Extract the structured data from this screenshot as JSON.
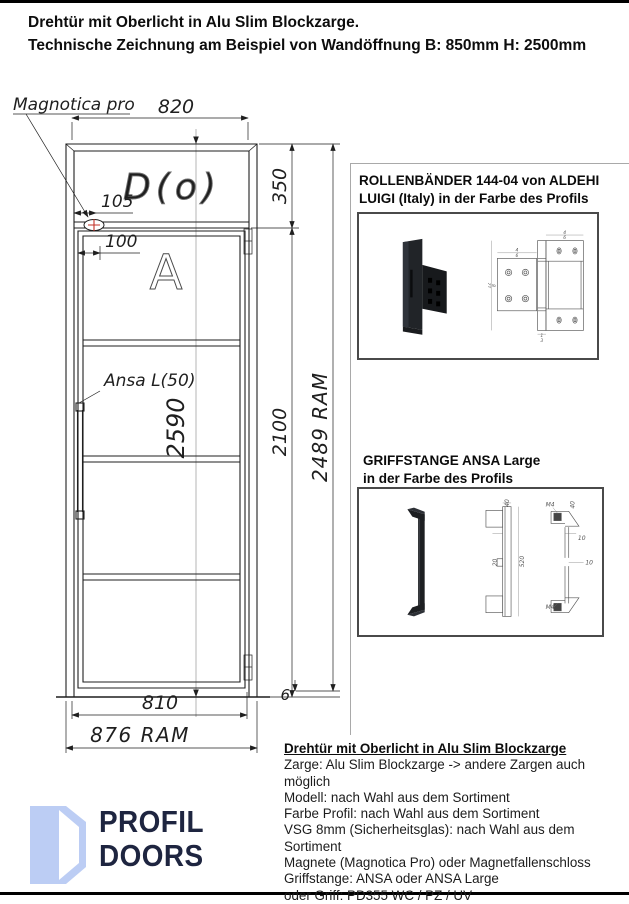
{
  "header": {
    "line1": "Drehtür mit Oberlicht in Alu Slim Blockzarge.",
    "line2": "Technische Zeichnung am Beispiel von Wandöffnung B: 850mm H: 2500mm"
  },
  "drawing": {
    "label_magnet": "Magnotica pro",
    "label_handle": "Ansa L(50)",
    "model_letter": "A",
    "watermark": "D(o)",
    "dim_top_width": "820",
    "dim_transom_height": "350",
    "dim_magnet_offset": "105",
    "dim_top_offset": "100",
    "dim_total_height": "2590",
    "dim_leaf_height": "2100",
    "dim_frame_height": "2489 RAM",
    "dim_leaf_width": "810",
    "dim_frame_width": "876 RAM",
    "dim_floor_gap": "6"
  },
  "hinge_panel": {
    "title_line1": "ROLLENBÄNDER 144-04 von ALDEHI",
    "title_line2": "LUIGI (Italy) in der Farbe des Profils",
    "dims": {
      "a": "4",
      "b": "6",
      "c": "12",
      "d": "3",
      "e": "1",
      "f": "8"
    }
  },
  "handle_panel": {
    "title_line1": "GRIFFSTANGE ANSA Large",
    "title_line2": "in der Farbe des Profils",
    "dims": {
      "d40": "40",
      "d20": "20",
      "d520": "520",
      "d10": "10",
      "m4": "M4"
    }
  },
  "specs": {
    "title": "Drehtür mit Oberlicht in Alu Slim Blockzarge",
    "lines": [
      "Zarge: Alu Slim Blockzarge -> andere Zargen auch möglich",
      "Modell: nach Wahl aus dem Sortiment",
      "Farbe Profil: nach Wahl aus dem Sortiment",
      "VSG 8mm (Sicherheitsglas): nach Wahl aus dem Sortiment",
      "Magnete (Magnotica Pro) oder Magnetfallenschloss",
      "Griffstange: ANSA oder ANSA Large",
      "oder Griff: PD355 WC / PZ / UV"
    ]
  },
  "logo": {
    "word1": "PROFIL",
    "word2": "DOORS"
  },
  "colors": {
    "logo_icon": "#bccdf4",
    "logo_text": "#1e2540",
    "magnet_marker": "#c23127",
    "line": "#1f1f1f"
  }
}
